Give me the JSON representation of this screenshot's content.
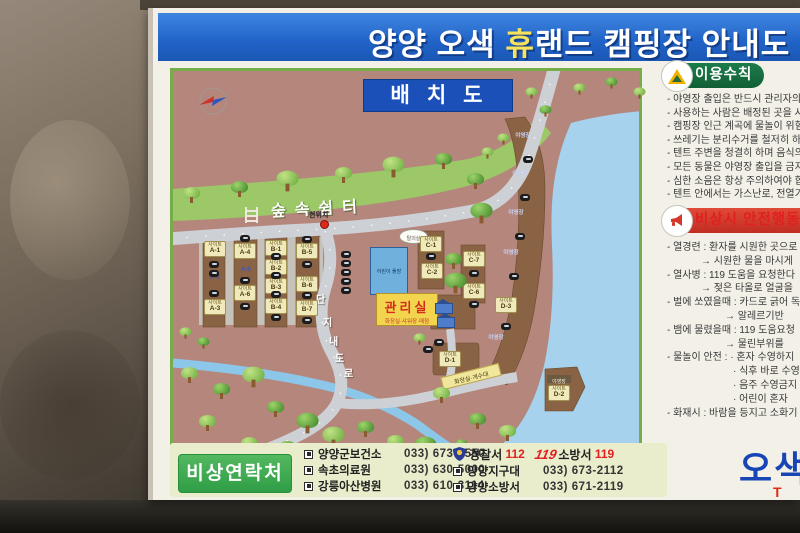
{
  "title": {
    "pre": "양양 오색 ",
    "highlight": "휴",
    "post": "랜드 캠핑장 안내도"
  },
  "map": {
    "title": "배치도",
    "forest_area": "숲속쉼터",
    "current_location": "현위치",
    "pool": "어린이 풀장",
    "changing_room": "탈의실",
    "office": "관리실",
    "office_sub": "화장실·샤워장·매점",
    "road_chars": [
      "단",
      "지",
      "내",
      "도",
      "로"
    ],
    "restroom_sink": "화장실·개수대",
    "camp_section": "야영장",
    "site_prefix": "사이트",
    "sites": {
      "a1": "A-1",
      "a2": "A-2",
      "a3": "A-3",
      "a4": "A-4",
      "a5": "A-5",
      "a6": "A-6",
      "b1": "B-1",
      "b2": "B-2",
      "b3": "B-3",
      "b4": "B-4",
      "b5": "B-5",
      "b6": "B-6",
      "b7": "B-7",
      "c1": "C-1",
      "c2": "C-2",
      "c6": "C-6",
      "c7": "C-7",
      "d1": "D-1",
      "d2": "D-2",
      "d3": "D-3"
    }
  },
  "rules": {
    "header": "이용수칙",
    "items": [
      "- 야영장 출입은 반드시 관리자의",
      "- 사용하는 사람은 배정된 곳을 사",
      "- 캠핑장 인근 계곡에 물놀이 위험",
      "- 쓰레기는 분리수거를 철저히 하",
      "- 텐트 주변을 청결히 하며 음식의",
      "- 모든 동물은 야영장 출입을 금지",
      "- 심한 소음은 항상 주의하여야 합",
      "- 텐트 안에서는 가스난로, 전열기"
    ]
  },
  "safety": {
    "header": "비상시 안전행동 요령",
    "items": [
      {
        "text": "- 열경련 : 환자를 시원한 곳으로",
        "indent": 0
      },
      {
        "text": "→ 시원한 물을 마시게",
        "indent": 1
      },
      {
        "text": "- 열사병 : 119 도움을 요청한다",
        "indent": 0
      },
      {
        "text": "→ 젖은 타올로 얼굴을",
        "indent": 1
      },
      {
        "text": "- 벌에 쏘였을때 : 카드로 긁어 독",
        "indent": 0
      },
      {
        "text": "→ 알레르기반",
        "indent": 2
      },
      {
        "text": "- 뱀에 물렸을때 : 119 도움요청",
        "indent": 0
      },
      {
        "text": "→ 물린부위를",
        "indent": 2
      },
      {
        "text": "- 물놀이 안전 : · 혼자 수영하지",
        "indent": 0
      },
      {
        "text": "· 식후 바로 수영",
        "indent": 3
      },
      {
        "text": "· 음주 수영금지",
        "indent": 3
      },
      {
        "text": "· 어린이 혼자",
        "indent": 3
      },
      {
        "text": "- 화재시 : 바람을 등지고 소화기",
        "indent": 0
      }
    ]
  },
  "contacts": {
    "header": "비상연락처",
    "medical": [
      {
        "name": "양양군보건소",
        "phone": "033) 673-2550"
      },
      {
        "name": "속초의료원",
        "phone": "033) 630-5000"
      },
      {
        "name": "강릉아산병원",
        "phone": "033) 610-3114"
      }
    ],
    "police_label": "경찰서",
    "police_number": "112",
    "fire_logo": "119",
    "fire_label": "소방서",
    "fire_number": "119",
    "agencies": [
      {
        "name": "양양지구대",
        "phone": "033) 673-2112"
      },
      {
        "name": "양양소방서",
        "phone": "033) 671-2119"
      }
    ]
  },
  "brand": {
    "name": "오색",
    "tel_prefix": "T"
  }
}
